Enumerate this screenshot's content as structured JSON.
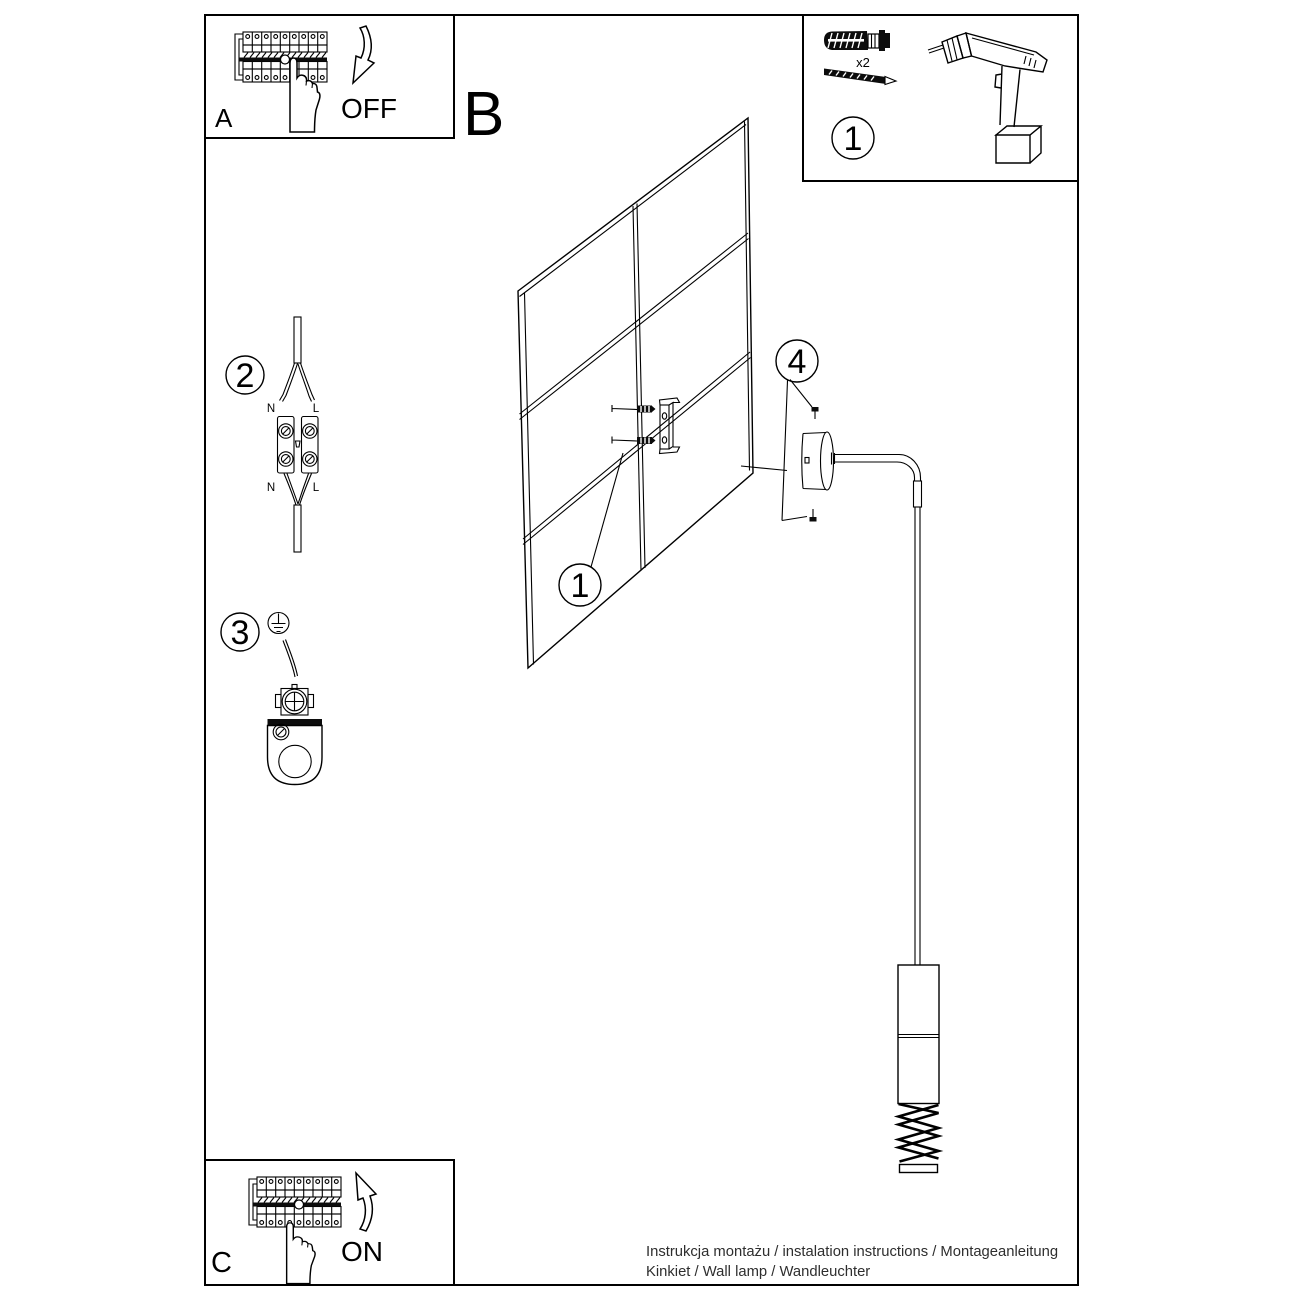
{
  "panels": {
    "breaker_off": {
      "letter": "A",
      "action_label": "OFF"
    },
    "main": {
      "letter": "B"
    },
    "breaker_on": {
      "letter": "C",
      "action_label": "ON"
    },
    "tools": {
      "step_number": "1",
      "quantity_label": "x2"
    }
  },
  "callouts": {
    "wall_fixing": "1",
    "wiring": "2",
    "grounding": "3",
    "canopy_screws": "4"
  },
  "wiring_labels": {
    "top_n": "N",
    "top_l": "L",
    "bottom_n": "N",
    "bottom_l": "L"
  },
  "footer": {
    "line1": "Instrukcja montażu / instalation instructions / Montageanleitung",
    "line2": "Kinkiet / Wall lamp / Wandleuchter"
  },
  "colors": {
    "ink": "#000000",
    "paper": "#ffffff"
  }
}
